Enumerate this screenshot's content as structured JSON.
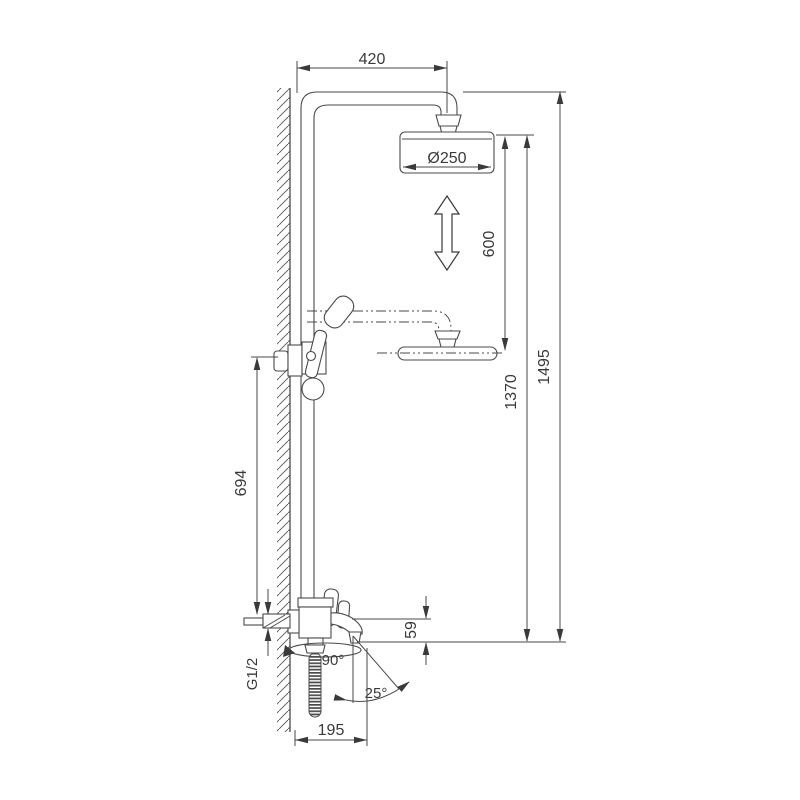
{
  "diagram": {
    "type": "technical-drawing",
    "subject": "wall-mounted shower column with overhead shower, hand shower and swivel tub spout (dimensioned side view)",
    "colors": {
      "background": "#ffffff",
      "line": "#4a4a4a",
      "text": "#3a3a3a"
    },
    "dimensions": {
      "arm_reach": "420",
      "head_diameter": "Ø250",
      "height_adjust_range": "600",
      "head_height_lowered": "1370",
      "total_height": "1495",
      "holder_to_inlet": "694",
      "spout_drop": "59",
      "inlet_thread": "G1/2",
      "spout_swivel": "90°",
      "spout_tilt": "25°",
      "spout_reach": "195"
    }
  }
}
